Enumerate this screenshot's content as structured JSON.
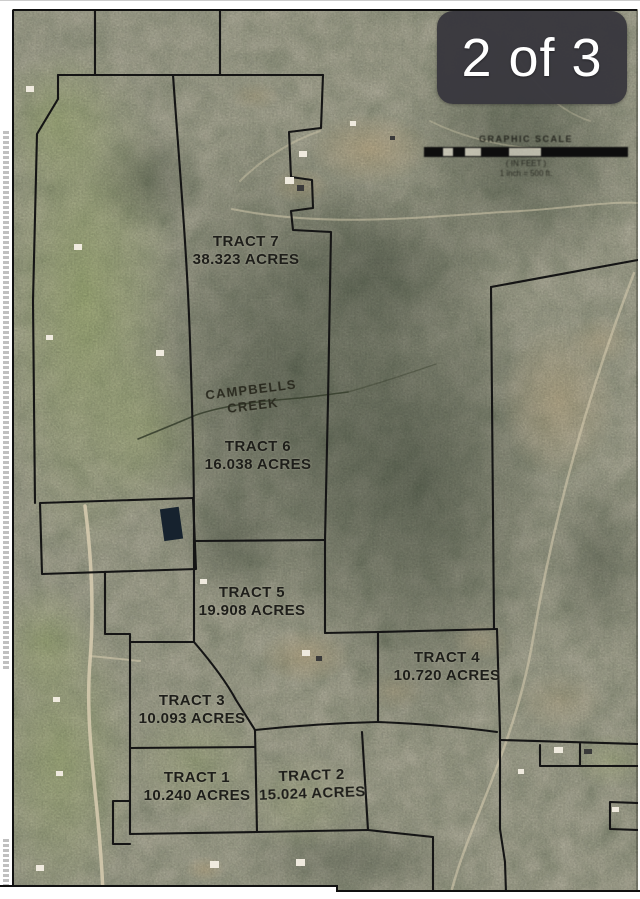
{
  "gallery": {
    "badge": "2 of 3"
  },
  "map": {
    "creek": {
      "line1": "CAMPBELLS",
      "line2": "CREEK"
    },
    "scale": {
      "title": "GRAPHIC SCALE",
      "units": "( IN FEET )",
      "ratio": "1 inch = 500 ft."
    },
    "tracts": [
      {
        "name": "TRACT 7",
        "acres": "38.323 ACRES"
      },
      {
        "name": "TRACT 6",
        "acres": "16.038 ACRES"
      },
      {
        "name": "TRACT 5",
        "acres": "19.908 ACRES"
      },
      {
        "name": "TRACT 4",
        "acres": "10.720 ACRES"
      },
      {
        "name": "TRACT 3",
        "acres": "10.093 ACRES"
      },
      {
        "name": "TRACT 2",
        "acres": "15.024 ACRES"
      },
      {
        "name": "TRACT 1",
        "acres": "10.240 ACRES"
      }
    ]
  },
  "colors": {
    "badge_bg": "#39383e",
    "badge_text": "#ffffff",
    "boundary_line": "#151515",
    "road": "#d8cdb0",
    "pond": "#16222e"
  }
}
